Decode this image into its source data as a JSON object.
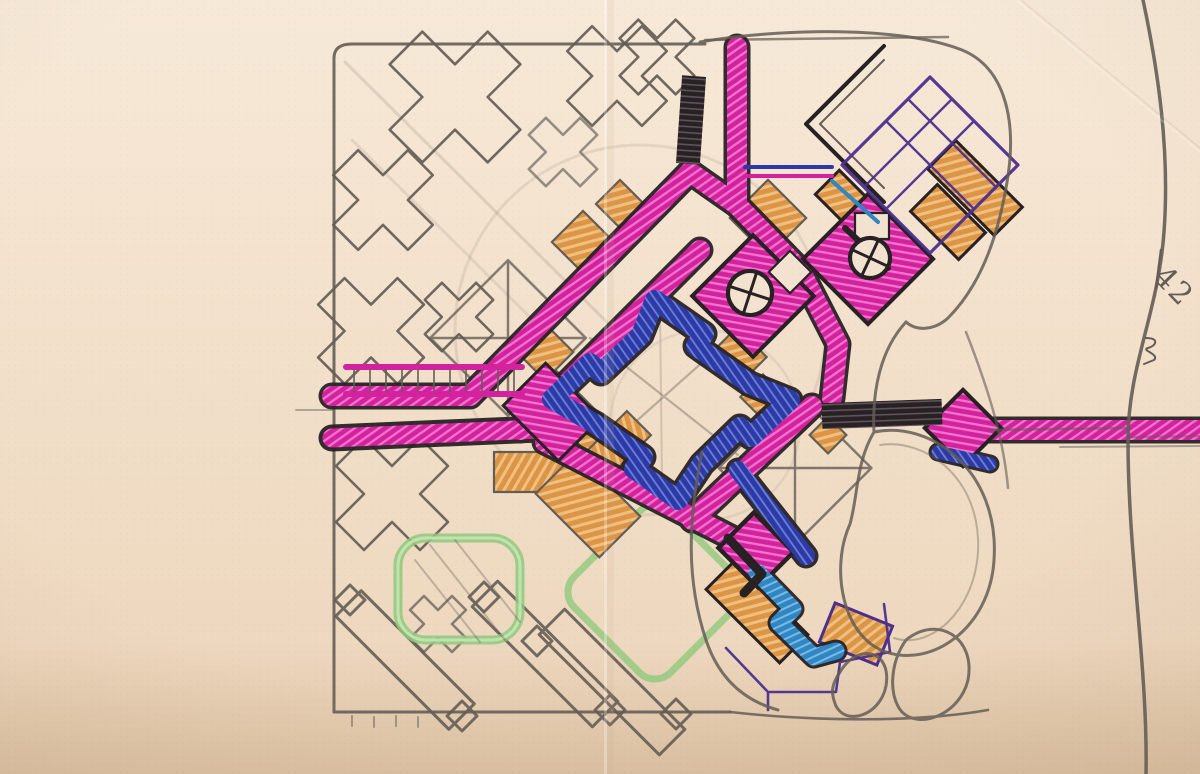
{
  "artwork": {
    "annotation": "42"
  },
  "palette": {
    "paper_top": "#f7e9d8",
    "paper_bottom": "#ecd5ba",
    "paper": "#f3e2cf",
    "pencil": "#645d55",
    "pencil_light": "#9b9187",
    "magenta": "#d4219e",
    "magenta_light": "#f075cd",
    "blue": "#2b3aa6",
    "blue_light": "#6b7fd6",
    "cyan": "#2f86c2",
    "cyan_light": "#79bbe4",
    "orange": "#dd9543",
    "orange_light": "#eec084",
    "green": "#8fc97d",
    "green_light": "#c6e6b6",
    "purple": "#4b2f8f",
    "ink": "#272124",
    "ink_light": "#5d5358"
  }
}
